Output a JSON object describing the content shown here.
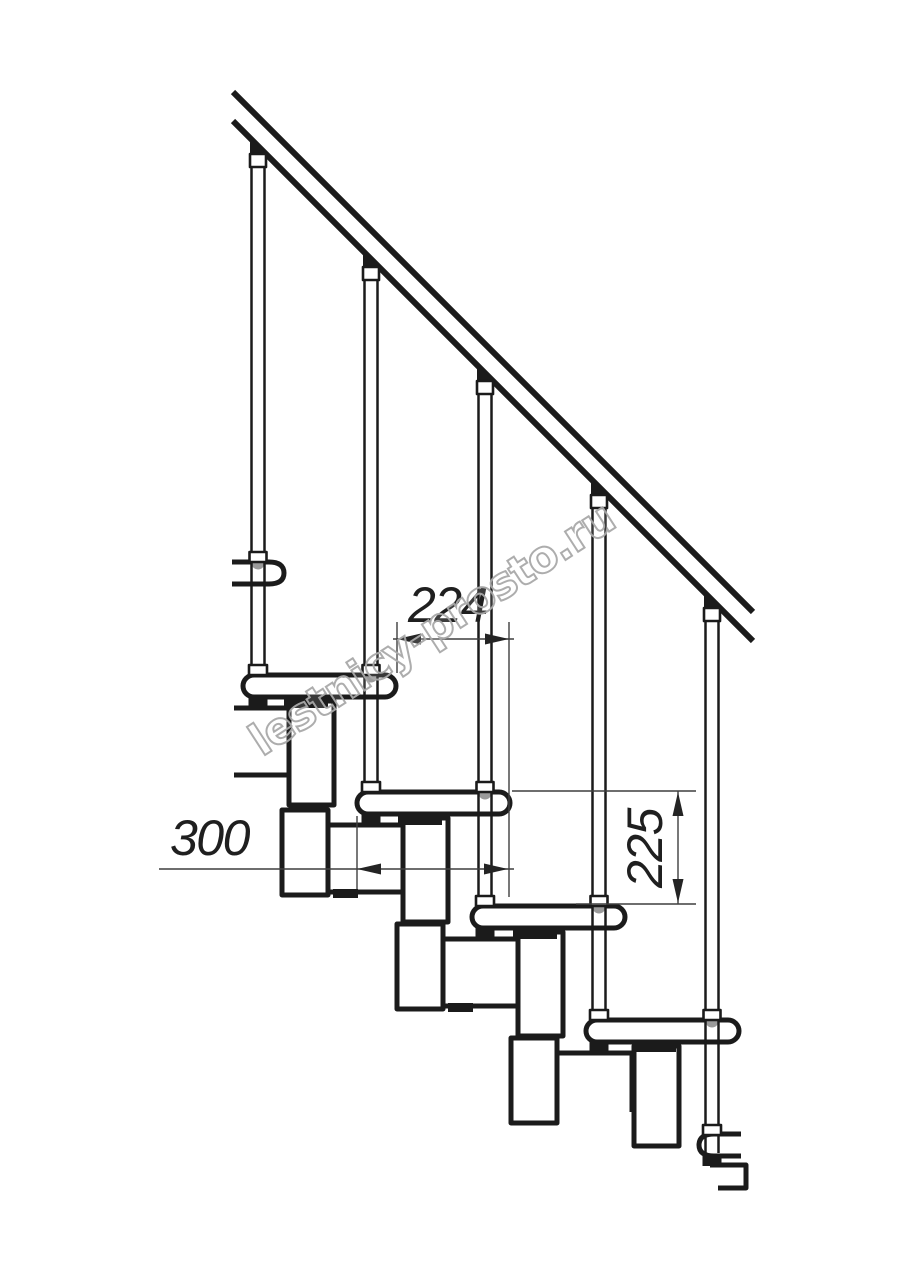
{
  "page": {
    "background": "#ffffff",
    "type_label": "staircase side-view technical drawing"
  },
  "colors": {
    "line": "#1b1b1b",
    "fill": "#ffffff",
    "joint": "#9a9a9a",
    "dim": "#3f3f3f",
    "dim_text": "#1f1f1f",
    "watermark_outline": "#a9a9a9"
  },
  "dims": {
    "d224": "224",
    "d300": "300",
    "d225": "225"
  },
  "dimensions_meta": [
    {
      "label": "224",
      "orientation": "horizontal",
      "measures": "step run between tread noses"
    },
    {
      "label": "300",
      "orientation": "horizontal",
      "measures": "tread depth"
    },
    {
      "label": "225",
      "orientation": "vertical",
      "measures": "step rise between tread tops"
    }
  ],
  "watermark": {
    "text": "lestnicy-prosto.ru"
  },
  "structure_meta": {
    "handrail_lines": 2,
    "balusters": 5,
    "full_treads": 4,
    "partial_treads": 2,
    "support_modules_visible": 5
  }
}
